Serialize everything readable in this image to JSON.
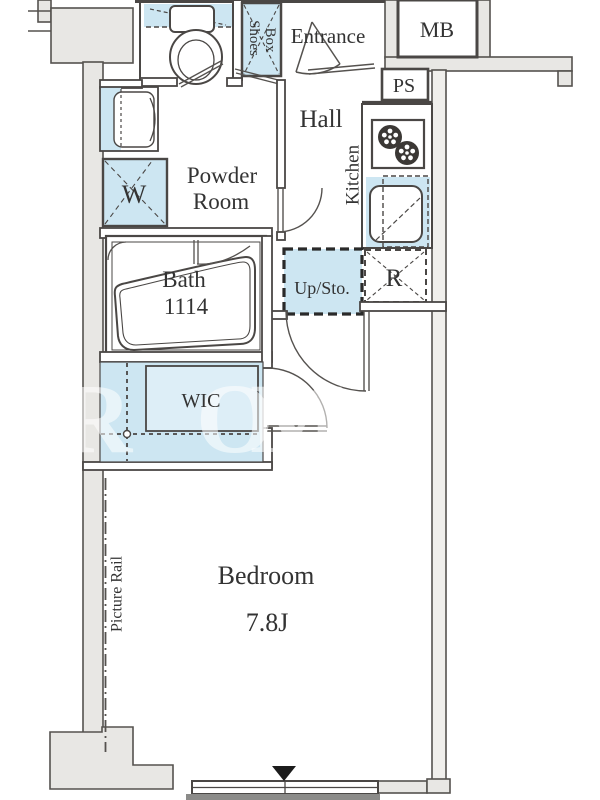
{
  "floorplan": {
    "rooms": {
      "entrance": "Entrance",
      "hall": "Hall",
      "kitchen": "Kitchen",
      "powder_room_line1": "Powder",
      "powder_room_line2": "Room",
      "bath_line1": "Bath",
      "bath_line2": "1114",
      "wic": "WIC",
      "bedroom_line1": "Bedroom",
      "bedroom_line2": "7.8J"
    },
    "fixtures": {
      "meter_box": "MB",
      "pipe_space": "PS",
      "shoes_box_line1": "Shoes",
      "shoes_box_line2": "Box",
      "washing_machine": "W",
      "refrigerator": "R",
      "upper_storage": "Up/Sto.",
      "picture_rail": "Picture Rail"
    },
    "watermark": {
      "l1": "R",
      "l2": "O",
      "l3": "M"
    },
    "colors": {
      "fixture_blue": "#cde6f2",
      "wall_gray": "#e8e7e4",
      "line": "#4a4745",
      "text": "#333333"
    }
  }
}
